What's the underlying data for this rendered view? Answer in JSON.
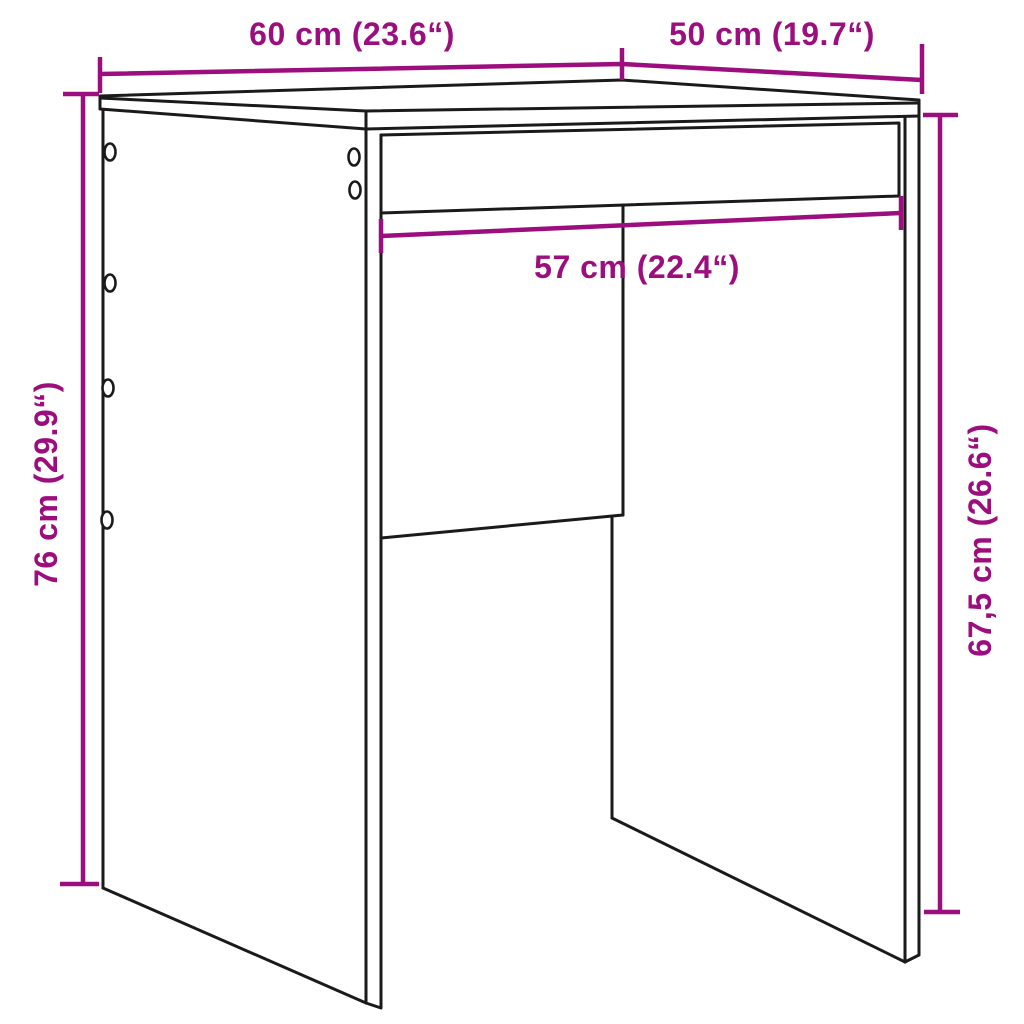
{
  "diagram": {
    "kind": "furniture-dimension-line-drawing",
    "background": "#ffffff",
    "colors": {
      "dimension_accent": "#9C0E7E",
      "outline": "#1a1a1a"
    },
    "dimensions": {
      "top_width": "60 cm (23.6“)",
      "top_depth": "50 cm (19.7“)",
      "inner_width": "57 cm (22.4“)",
      "total_height": "76 cm (29.9“)",
      "side_height": "67,5 cm (26.6“)"
    },
    "screw_hole_count": "6"
  }
}
